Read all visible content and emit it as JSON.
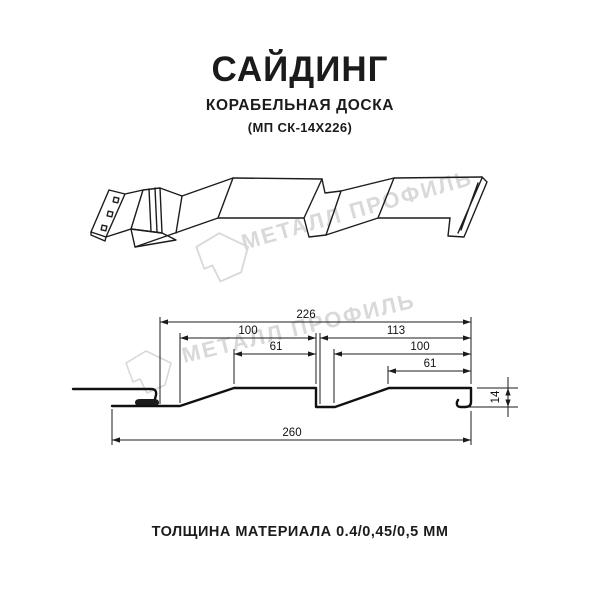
{
  "header": {
    "title": "САЙДИНГ",
    "subtitle": "КОРАБЕЛЬНАЯ ДОСКА",
    "model": "(МП СК-14Х226)"
  },
  "footer": {
    "text": "ТОЛЩИНА МАТЕРИАЛА 0.4/0,45/0,5 ММ"
  },
  "watermark": {
    "text": "МЕТАЛЛ ПРОФИЛЬ",
    "logo": "gem-icon",
    "color": "#d9d9d9"
  },
  "colors": {
    "background": "#ffffff",
    "line": "#1b1b1b",
    "watermark": "#d9d9d9"
  },
  "section": {
    "dims": {
      "overall": "226",
      "pitch_left": "100",
      "panel_right": "113",
      "crest_left": "61",
      "pitch_right": "100",
      "crest_right": "61",
      "total": "260",
      "height": "14"
    }
  }
}
